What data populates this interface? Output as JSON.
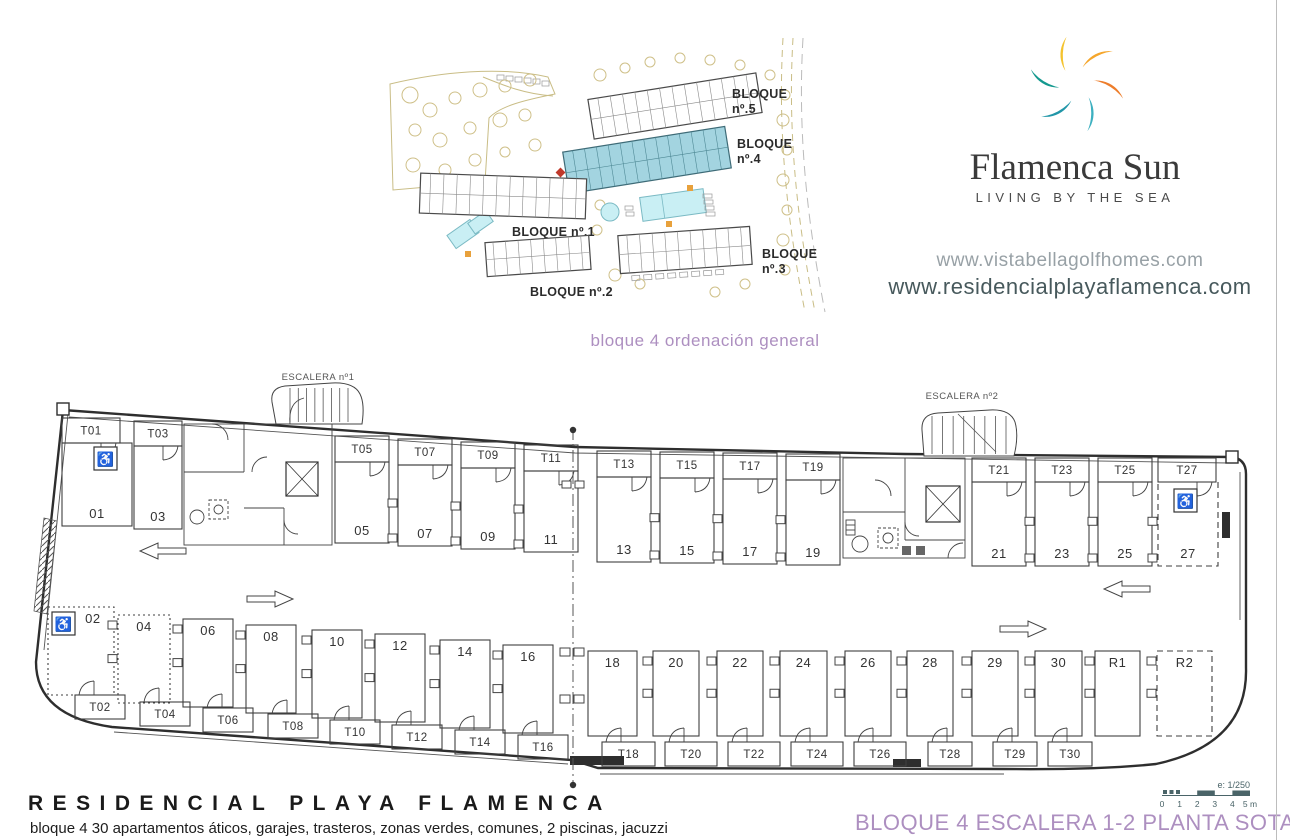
{
  "site_plan": {
    "caption": "bloque 4 ordenación general",
    "blocks": [
      {
        "lines": [
          "BLOQUE",
          "nº.5"
        ]
      },
      {
        "lines": [
          "BLOQUE",
          "nº.4"
        ],
        "highlighted": true
      },
      {
        "lines": [
          "BLOQUE nº.1"
        ]
      },
      {
        "lines": [
          "BLOQUE nº.2"
        ]
      },
      {
        "lines": [
          "BLOQUE",
          "nº.3"
        ]
      }
    ],
    "colors": {
      "highlight": "#a3d4e0",
      "pool": "#c9eff4",
      "tree": "#cfc089",
      "accent_red": "#c0392b"
    }
  },
  "brand": {
    "name": "Flamenca Sun",
    "tagline": "LIVING BY THE SEA",
    "urls": {
      "primary": "www.vistabellagolfhomes.com",
      "secondary": "www.residencialplayaflamenca.com"
    },
    "logo_colors": [
      "#f5a62b",
      "#ed7d2b",
      "#3db0c0",
      "#2196a8",
      "#14998f",
      "#f4c32f"
    ]
  },
  "floor_plan": {
    "stair1_label": "ESCALERA nº1",
    "stair2_label": "ESCALERA nº2",
    "accessible_icon": "♿",
    "top_left": {
      "storage": [
        "T01",
        "T03"
      ],
      "parking": [
        "01",
        "03"
      ]
    },
    "top_wing1": {
      "storage": [
        "T05",
        "T07",
        "T09",
        "T11"
      ],
      "parking": [
        "05",
        "07",
        "09",
        "11"
      ]
    },
    "top_wing2": {
      "storage": [
        "T13",
        "T15",
        "T17",
        "T19"
      ],
      "parking": [
        "13",
        "15",
        "17",
        "19"
      ]
    },
    "top_wing3": {
      "storage": [
        "T21",
        "T23",
        "T25",
        "T27"
      ],
      "parking": [
        "21",
        "23",
        "25",
        "27"
      ]
    },
    "bottom_wing1": {
      "parking": [
        "02",
        "04",
        "06",
        "08",
        "10",
        "12",
        "14",
        "16"
      ],
      "storage": [
        "T02",
        "T04",
        "T06",
        "T08",
        "T10",
        "T12",
        "T14",
        "T16"
      ]
    },
    "bottom_wing2": {
      "parking": [
        "18",
        "20",
        "22",
        "24",
        "26",
        "28",
        "29",
        "30",
        "R1",
        "R2"
      ],
      "storage": [
        "T18",
        "T20",
        "T22",
        "T24",
        "T26",
        "T28",
        "T29",
        "T30"
      ]
    },
    "accessible_spaces": [
      "01",
      "02",
      "27"
    ],
    "dotted_spaces": [
      "02",
      "04"
    ],
    "dashed_spaces": [
      "27",
      "R2"
    ]
  },
  "scale_bar": {
    "ratio": "e: 1/250",
    "ticks": [
      "0",
      "1",
      "2",
      "3",
      "4",
      "5 m"
    ]
  },
  "footer": {
    "title": "RESIDENCIAL PLAYA FLAMENCA",
    "subtitle": "bloque 4 30 apartamentos áticos, garajes, trasteros, zonas verdes, comunes, 2 piscinas, jacuzzi",
    "sheet_title": "BLOQUE 4 ESCALERA 1-2 PLANTA SOTANO",
    "accent_color": "#ad8fc0"
  }
}
